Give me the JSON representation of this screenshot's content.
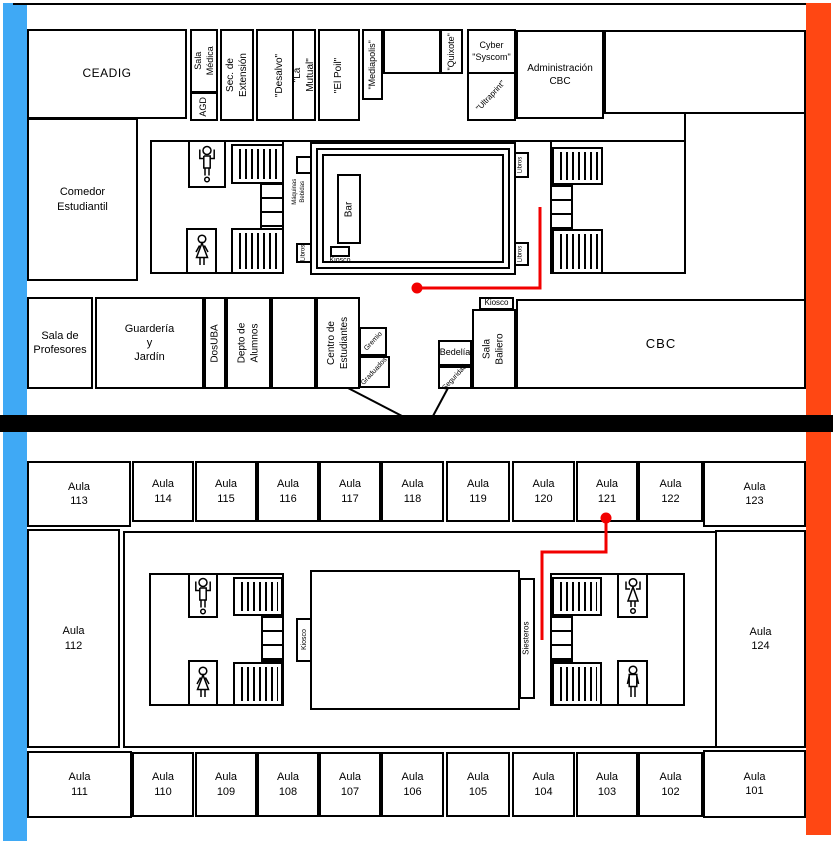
{
  "colors": {
    "left_stripe": "#3FA9F5",
    "right_stripe": "#FF4713",
    "separator": "#000000",
    "route": "#F20000",
    "wall": "#000000"
  },
  "icons": {
    "mens_restroom": "stick-figure-arms-up",
    "womens_restroom": "dress-figure",
    "route_marker": "red-dot",
    "staircase": "hatched-rectangle"
  },
  "upper": {
    "ceadig": "CEADIG",
    "sala_medica": "Sala\nMédica",
    "agd": "AGD",
    "sec_extension": "Sec. de\nExtensión",
    "desalvo": "\"Desalvo\"",
    "la_mutual": "\"La Mutual\"",
    "el_poil": "\"El Poil\"",
    "mediapolis": "\"Mediapolis\"",
    "quixote": "\"Quixote\"",
    "cyber_syscom": "Cyber\n\"Syscom\"",
    "ultraprint": "\"Ultraprint\"",
    "admin_cbc": "Administración\nCBC",
    "comedor": "Comedor\nEstudiantil",
    "sala_profesores": "Sala de\nProfesores",
    "guarderia": "Guardería\ny\nJardín",
    "dosuba": "DosUBA",
    "depto_alumnos": "Depto de\nAlumnos",
    "centro_estudiantes": "Centro de\nEstudiantes",
    "gremio": "Gremio",
    "graduados": "Graduados",
    "kiosco_baliero": "Kiosco",
    "sala_baliero": "Sala\nBaliero",
    "bedelia": "Bedelía",
    "seguridad": "Seguridad",
    "cbc": "CBC",
    "bar": "Bar",
    "kiosco_bar": "Kiosco",
    "maquinas": "Máquinas\nBebidas",
    "libros": "Libros"
  },
  "lower": {
    "aula_word": "Aula",
    "top_row": [
      "113",
      "114",
      "115",
      "116",
      "117",
      "118",
      "119",
      "120",
      "121",
      "122",
      "123"
    ],
    "bottom_row": [
      "111",
      "110",
      "109",
      "108",
      "107",
      "106",
      "105",
      "104",
      "103",
      "102",
      "101"
    ],
    "left_room": "112",
    "right_room": "124",
    "kiosco": "Kiosco",
    "siesteros": "Siesteros"
  }
}
